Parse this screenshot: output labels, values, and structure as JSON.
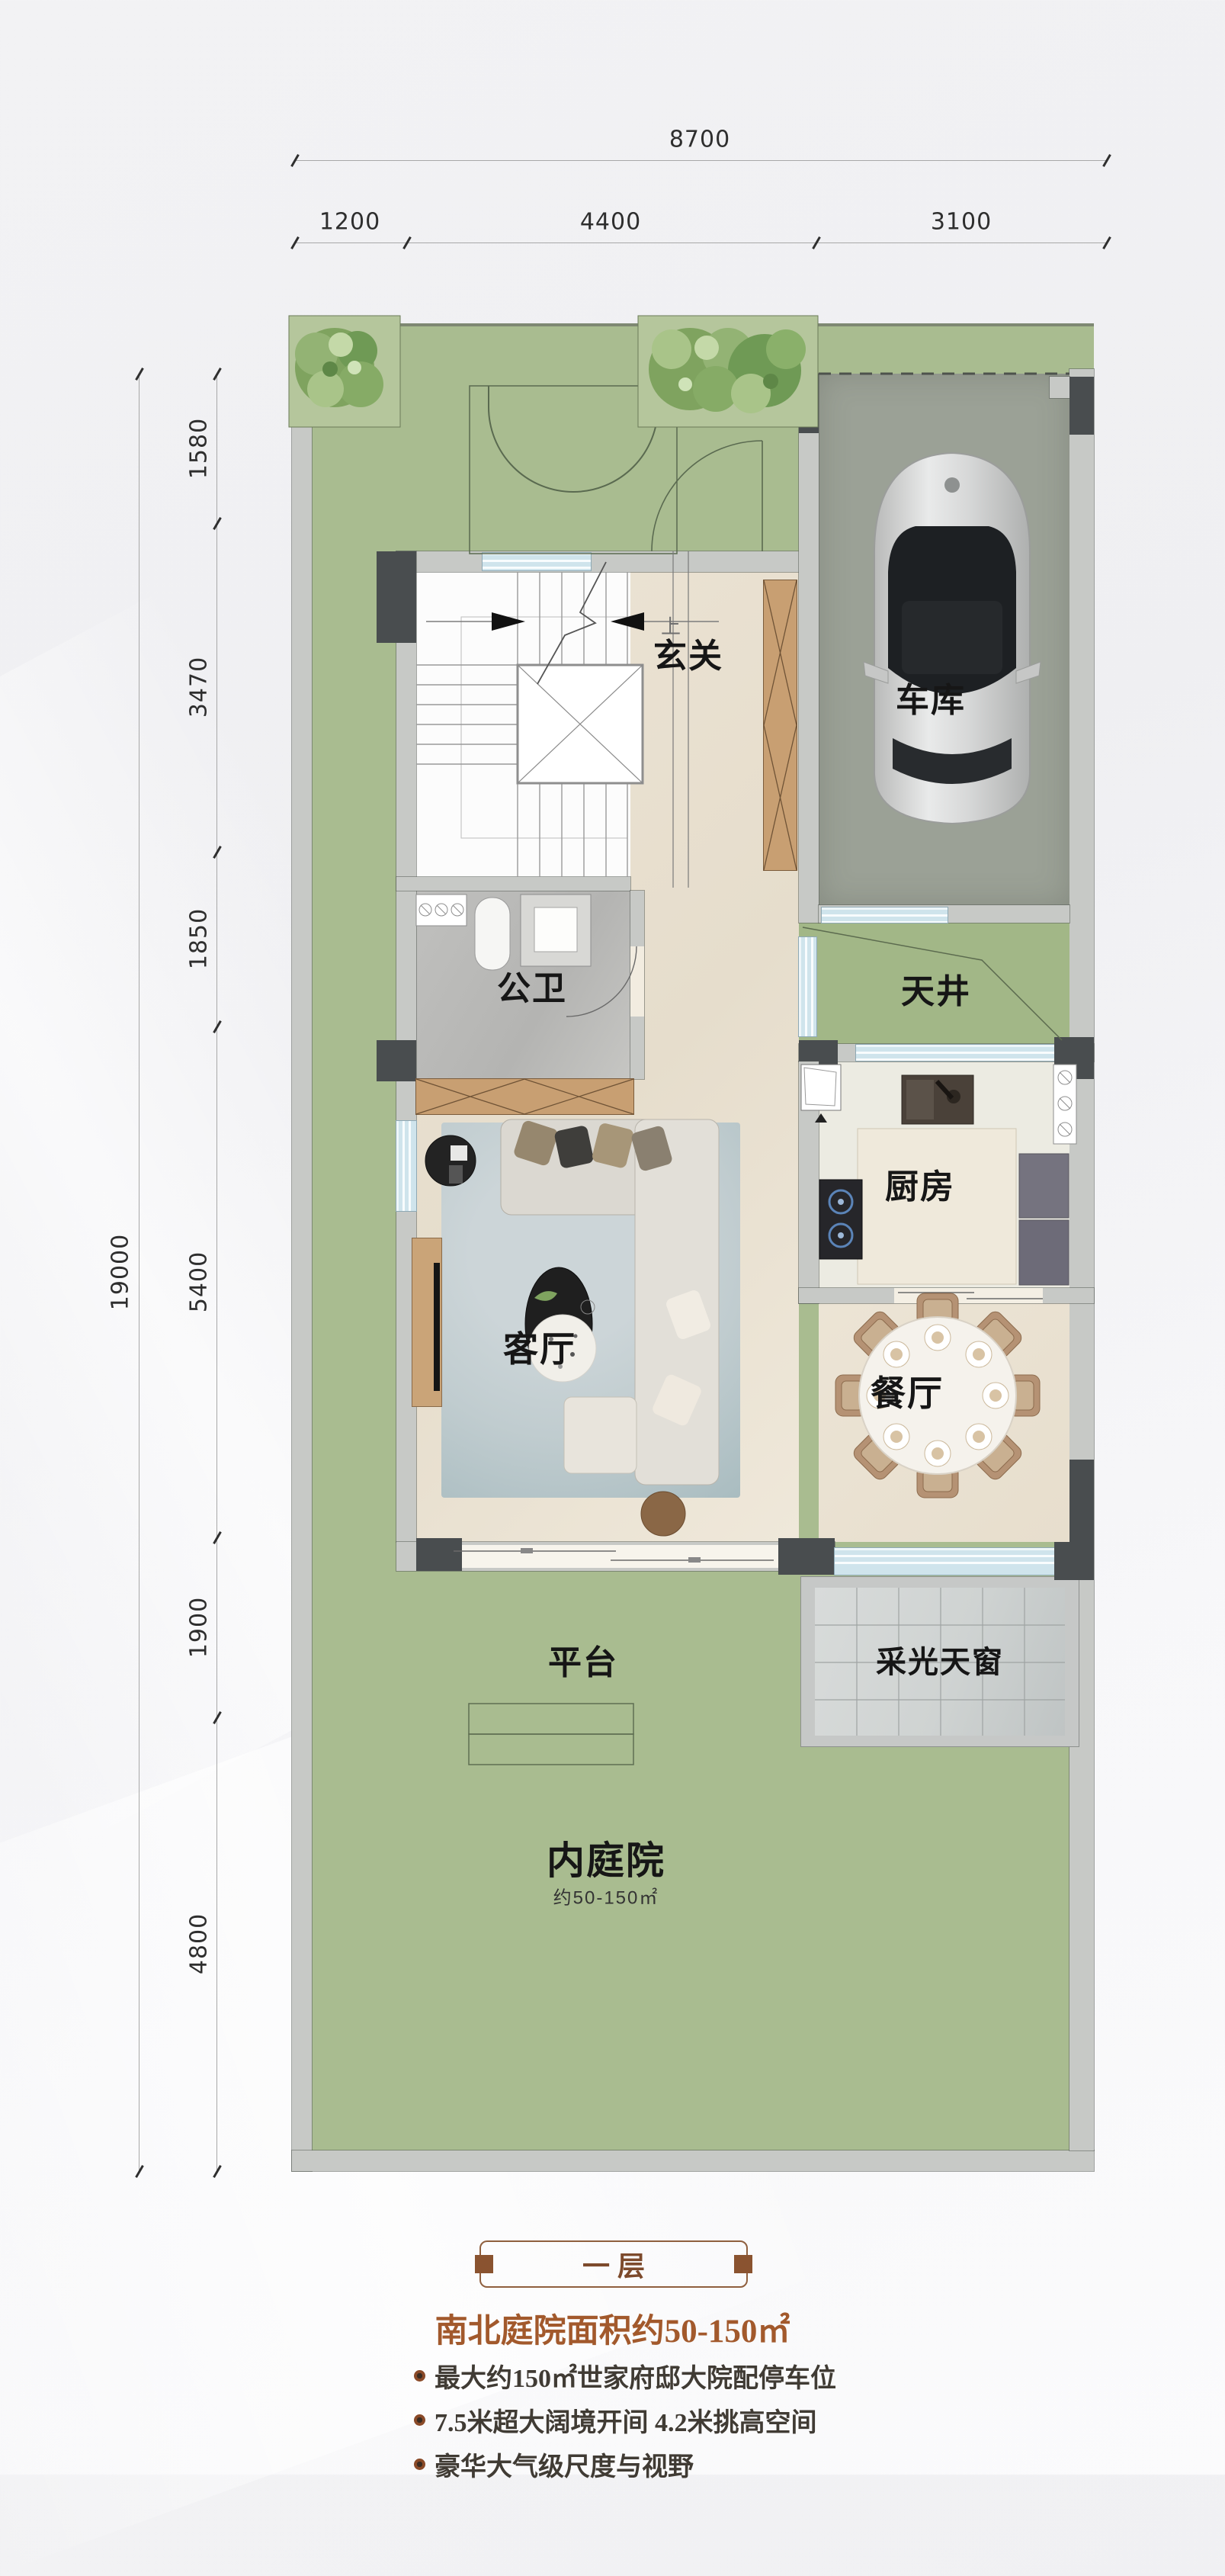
{
  "dimensions": {
    "top_total": "8700",
    "top_segments": [
      "1200",
      "4400",
      "3100"
    ],
    "left_total": "19000",
    "left_segments": [
      "1580",
      "3470",
      "1850",
      "5400",
      "1900",
      "4800"
    ]
  },
  "rooms": {
    "entry": "玄关",
    "garage": "车库",
    "bath": "公卫",
    "lightwell": "天井",
    "kitchen": "厨房",
    "living": "客厅",
    "dining": "餐厅",
    "terrace": "平台",
    "skylight": "采光天窗",
    "courtyard": "内庭院",
    "courtyard_area": "约50-150㎡",
    "stair_up": "上"
  },
  "footer": {
    "floor_badge": "一层",
    "subtitle": "南北庭院面积约50-150㎡",
    "bullets": [
      "最大约150㎡世家府邸大院配停车位",
      "7.5米超大阔境开间 4.2米挑高空间",
      "豪华大气级尺度与视野"
    ]
  },
  "colors": {
    "courtyard_green": "#a9bc90",
    "garage_concrete": "#9ba196",
    "floor_cream": "#eae2d3",
    "window_blue": "#cfe4ec",
    "wall_gray": "#c7c9c6",
    "wall_dark": "#494d4f",
    "wood": "#c89f72",
    "accent_brown": "#8f5f3e",
    "title_brown": "#a2592c"
  }
}
